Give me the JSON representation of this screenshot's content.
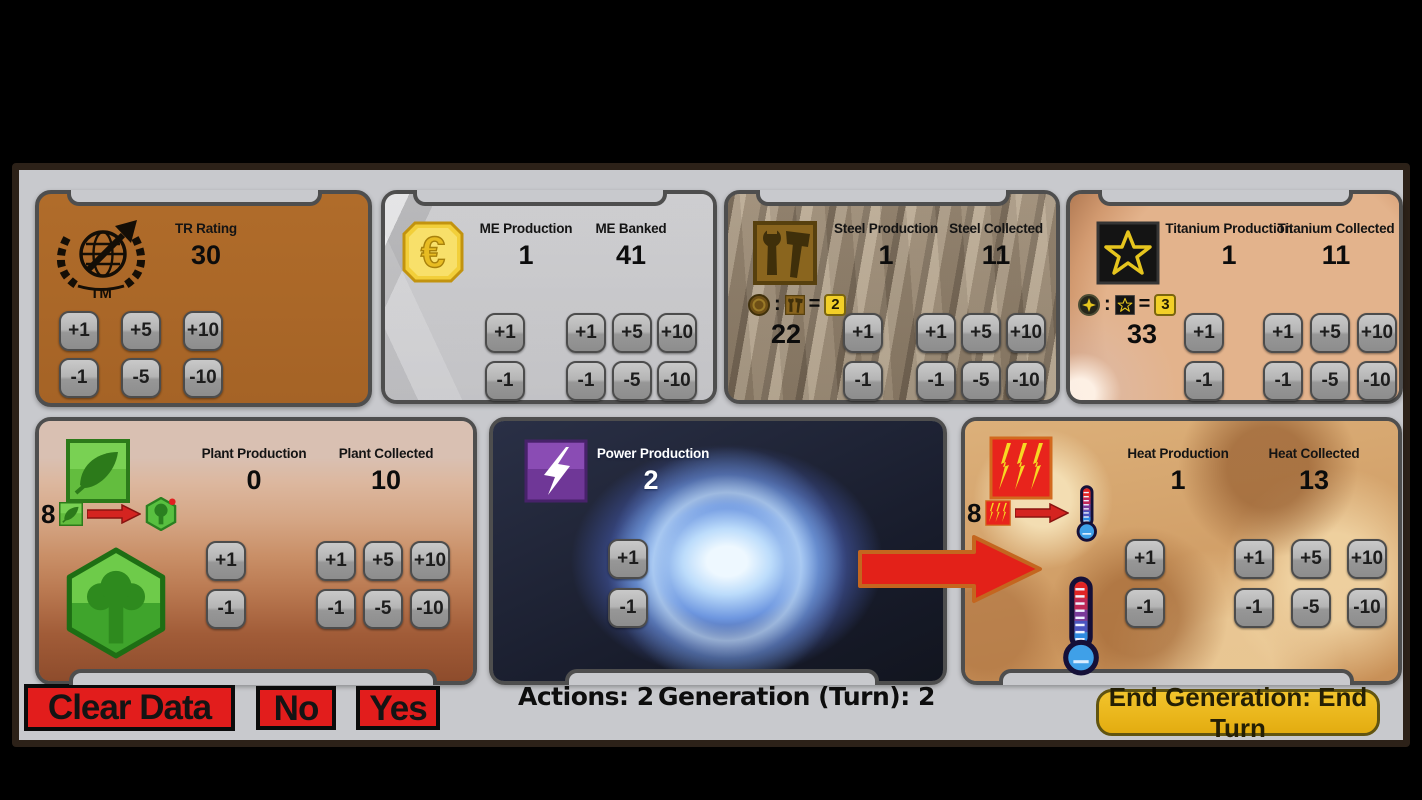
{
  "buttons": {
    "plus1": "+1",
    "plus5": "+5",
    "plus10": "+10",
    "minus1": "-1",
    "minus5": "-5",
    "minus10": "-10"
  },
  "symbols": {
    "colon": ":",
    "equals": "="
  },
  "panels": {
    "tr": {
      "title": "TR Rating",
      "value": "30",
      "logo_text": "TM"
    },
    "me": {
      "production_label": "ME Production",
      "production_value": "1",
      "banked_label": "ME Banked",
      "banked_value": "41",
      "euro_symbol": "€"
    },
    "steel": {
      "production_label": "Steel Production",
      "production_value": "1",
      "collected_label": "Steel Collected",
      "collected_value": "11",
      "trade_rate": "2",
      "trade_value": "22"
    },
    "titanium": {
      "production_label": "Titanium Production",
      "production_value": "1",
      "collected_label": "Titanium Collected",
      "collected_value": "11",
      "trade_rate": "3",
      "trade_value": "33"
    },
    "plant": {
      "production_label": "Plant Production",
      "production_value": "0",
      "collected_label": "Plant Collected",
      "collected_value": "10",
      "convert_count": "8"
    },
    "power": {
      "production_label": "Power Production",
      "production_value": "2"
    },
    "heat": {
      "production_label": "Heat Production",
      "production_value": "1",
      "collected_label": "Heat Collected",
      "collected_value": "13",
      "convert_count": "8"
    }
  },
  "footer": {
    "clear": "Clear Data",
    "no": "No",
    "yes": "Yes",
    "actions_label": "Actions:",
    "actions_value": "2",
    "generation_label": "Generation (Turn):",
    "generation_value": "2",
    "end_turn": "End Generation: End Turn"
  },
  "icons": {
    "tr_logo": "terraforming-mars-tm-logo",
    "me": "megacredit-euro-coin",
    "steel": "steel-tools",
    "titanium": "titanium-star",
    "plant": "plant-leaf",
    "power": "power-lightning",
    "heat": "heat-bolts",
    "greenery": "greenery-tile-hex",
    "thermometer": "temperature-thermometer",
    "arrow": "convert-arrow"
  },
  "colors": {
    "tr_panel": "#ab6827",
    "panel_border": "#4e4e4e",
    "background": "#c8c9cd",
    "frame": "#2c2118",
    "red_button": "#e21d1c",
    "gold_button": "#e8b41e",
    "rate_badge": "#f2cf28",
    "arrow_red": "#e32119",
    "arrow_outline": "#c4661f"
  }
}
